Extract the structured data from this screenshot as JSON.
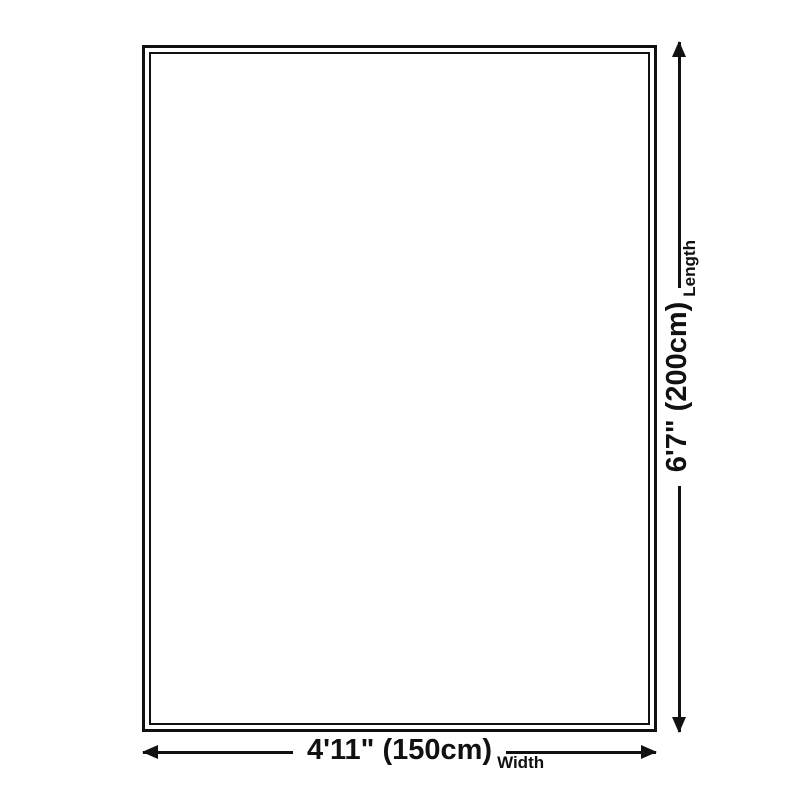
{
  "page": {
    "background_color": "#ffffff",
    "ink_color": "#111111"
  },
  "diagram": {
    "kind": "product-size-diagram",
    "length": {
      "value": "6'7\" (200cm)",
      "label": "Length"
    },
    "width": {
      "value": "4'11\" (150cm)",
      "label": "Width"
    },
    "icons": {
      "arrow_up": "▲",
      "arrow_down": "▼",
      "arrow_left": "◀",
      "arrow_right": "▶"
    }
  }
}
